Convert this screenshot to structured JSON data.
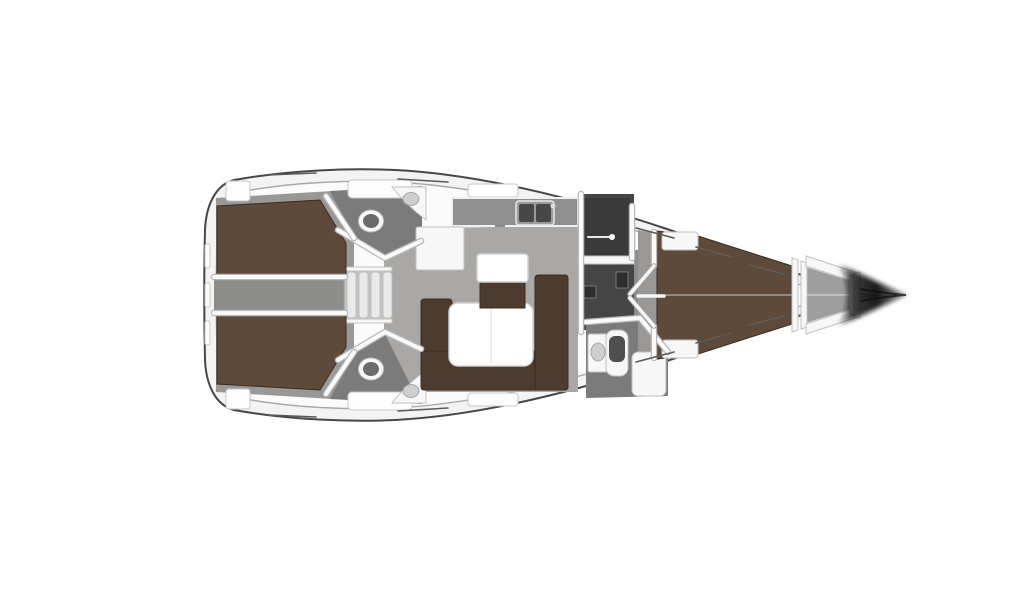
{
  "figure": {
    "type": "yacht-floor-plan",
    "description": "Top-down interior layout plan of a sailing yacht, bow pointing right, rendered on a white background with no text labels",
    "orientation": "bow-right"
  },
  "colors": {
    "background": "#ffffff",
    "deck": "#f3f3f3",
    "inner_wall": "#fbfbfb",
    "floor_salon": "#a9a8a6",
    "floor_cabin": "#9a9896",
    "floor_head": "#7b7b7b",
    "floor_corridor": "#8d8d8b",
    "floor_locker": "#9e9e9e",
    "wet_room": "#454545",
    "wet_room_inner": "#3a3a3a",
    "bed_brown": "#5e4a3a",
    "settee_brown": "#4d3b2d",
    "counter_gray": "#8f8f8f",
    "sink_basin": "#474747",
    "bow_shadow": "#101010"
  },
  "rooms": [
    {
      "id": "aft-cabin-port",
      "label": "Aft double cabin port",
      "furniture": [
        "double-berth"
      ]
    },
    {
      "id": "aft-cabin-starboard",
      "label": "Aft double cabin starboard",
      "furniture": [
        "double-berth"
      ]
    },
    {
      "id": "center-passage",
      "label": "Center passage between aft cabins",
      "furniture": []
    },
    {
      "id": "companionway",
      "label": "Companionway steps",
      "furniture": [
        "steps"
      ]
    },
    {
      "id": "aft-head-port",
      "label": "Aft head port",
      "furniture": [
        "toilet",
        "corner-sink"
      ]
    },
    {
      "id": "aft-head-starboard",
      "label": "Aft head starboard",
      "furniture": [
        "toilet",
        "corner-sink"
      ]
    },
    {
      "id": "galley",
      "label": "Galley",
      "furniture": [
        "l-counter",
        "double-sink"
      ]
    },
    {
      "id": "salon",
      "label": "Salon",
      "furniture": [
        "u-settee",
        "dining-table",
        "cabinet"
      ]
    },
    {
      "id": "wet-room",
      "label": "Shower compartment",
      "furniture": [
        "sliding-door"
      ]
    },
    {
      "id": "forward-head",
      "label": "Forward head",
      "furniture": [
        "vanity-sink",
        "toilet",
        "shower-seat"
      ]
    },
    {
      "id": "forward-cabin",
      "label": "Forward cabin",
      "furniture": [
        "v-berth",
        "lockers"
      ]
    },
    {
      "id": "anchor-locker",
      "label": "Anchor locker",
      "furniture": []
    }
  ]
}
